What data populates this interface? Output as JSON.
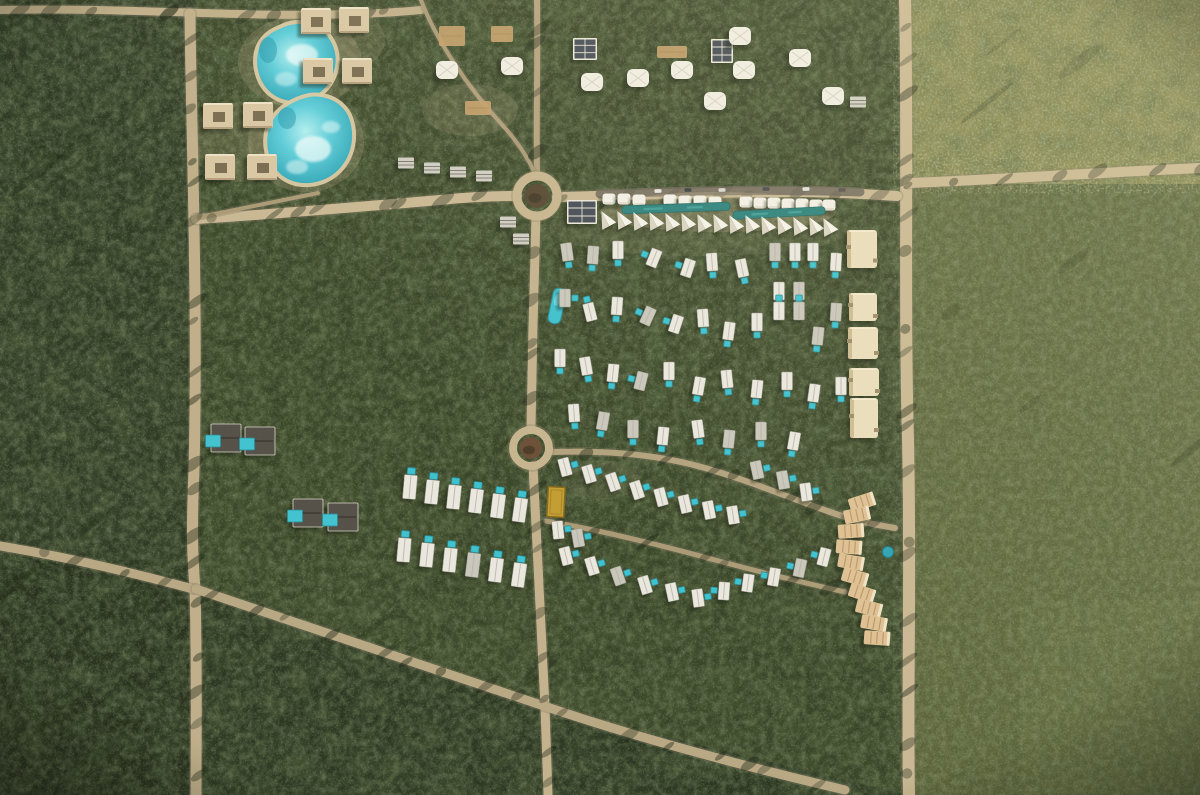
{
  "scene": {
    "size": {
      "w": 1200,
      "h": 795
    },
    "palette": {
      "jungle_dark": "#2f3a24",
      "jungle_mid": "#394528",
      "jungle_low": "#2c3822",
      "olive_block": "#84854f",
      "olive_right": "#5b6339",
      "road_tan": "#c9b893",
      "road_dim": "#bfae89",
      "asphalt": "#6e675c",
      "water_light": "#b2eef0",
      "water_mid": "#5ecdd9",
      "water_deep": "#31a5b6",
      "pool_teal": "#3fc2ce",
      "pool_strip": "#2e827d",
      "building_tan": "#d9c7a3",
      "building_white": "#eae7df",
      "building_cream": "#e9ddbb",
      "building_terracotta": "#ddc093",
      "solar_panel": "#474e56",
      "court_yellow": "#c29e33"
    },
    "regions": [
      {
        "name": "base-jungle",
        "shape": "rect",
        "x": 0,
        "y": 0,
        "w": 1200,
        "h": 795,
        "fill": "#36412a",
        "op": 1
      },
      {
        "name": "left-jungle-strip",
        "shape": "rect",
        "x": 0,
        "y": 0,
        "w": 196,
        "h": 795,
        "fill": "#2f3a24",
        "op": 1
      },
      {
        "name": "central-jungle",
        "shape": "rect",
        "x": 196,
        "y": 0,
        "w": 712,
        "h": 795,
        "fill": "#394528",
        "op": 1
      },
      {
        "name": "south-jungle-wedge",
        "shape": "poly",
        "points": "196,592 545,708 908,795 196,795",
        "fill": "#2c3822",
        "op": 1
      },
      {
        "name": "bottom-left-jungle",
        "shape": "rect",
        "x": 0,
        "y": 560,
        "w": 196,
        "h": 235,
        "fill": "#28321e",
        "op": 1
      },
      {
        "name": "top-right-olive-parcel",
        "shape": "rect",
        "x": 908,
        "y": 0,
        "w": 292,
        "h": 184,
        "fill": "#84854f",
        "op": 1
      },
      {
        "name": "right-olive-parcel",
        "shape": "rect",
        "x": 908,
        "y": 184,
        "w": 292,
        "h": 611,
        "fill": "#5b6339",
        "op": 1
      },
      {
        "name": "right-lower-light-patch",
        "shape": "rect",
        "x": 1020,
        "y": 600,
        "w": 180,
        "h": 195,
        "fill": "#646d40",
        "op": 0.5
      }
    ],
    "roads": [
      {
        "name": "top-edge-road",
        "d": "M0,10 C80,8 160,12 240,14 C320,16 380,14 421,10",
        "w": 8,
        "color": "#c0af8a"
      },
      {
        "name": "left-perimeter-road",
        "d": "M190,14 C191,120 198,300 194,470 C191,540 193,560 195,590 C197,660 196,730 196,795",
        "w": 11,
        "color": "#c0af8a"
      },
      {
        "name": "right-perimeter-road",
        "d": "M905,0 C908,140 904,300 908,440 C911,580 907,700 909,795",
        "w": 12,
        "color": "#c9b893"
      },
      {
        "name": "west-main-avenue",
        "d": "M196,219 C280,214 380,205 440,200 C470,197 495,196 517,196",
        "w": 10,
        "color": "#c9b893"
      },
      {
        "name": "north-service-track",
        "d": "M537,174 C536,120 538,60 537,0",
        "w": 6,
        "color": "#b3a27e"
      },
      {
        "name": "east-main-avenue",
        "d": "M557,197 C640,195 720,192 790,192 C830,192 865,194 897,196",
        "w": 10,
        "color": "#c9b893"
      },
      {
        "name": "northeast-boundary-road",
        "d": "M908,183 C990,180 1090,173 1200,168",
        "w": 10,
        "color": "#c9b893"
      },
      {
        "name": "central-spine-north",
        "d": "M536,216 C534,280 532,360 531,427",
        "w": 9,
        "color": "#c3b28d"
      },
      {
        "name": "central-spine-south",
        "d": "M533,466 C537,540 541,630 545,707 C546,740 547,770 548,795",
        "w": 9,
        "color": "#c3b28d"
      },
      {
        "name": "west-entry-road",
        "d": "M0,546 C60,556 130,572 193,589",
        "w": 9,
        "color": "#b9a884"
      },
      {
        "name": "southeast-diagonal-road",
        "d": "M196,589 C300,624 430,668 544,706 C650,742 760,770 845,790",
        "w": 9,
        "color": "#b9a884"
      },
      {
        "name": "villa-loop-north",
        "d": "M553,452 C610,450 660,455 705,468 C750,481 790,498 830,512 C855,521 875,525 895,528",
        "w": 6,
        "color": "#b3a27e"
      },
      {
        "name": "villa-loop-south",
        "d": "M546,521 C600,530 660,545 715,560 C760,572 800,582 845,592",
        "w": 5,
        "color": "#ab9a76"
      },
      {
        "name": "lagoon-footpath",
        "d": "M200,217 C240,209 280,201 318,193",
        "w": 4,
        "color": "#ab9a76"
      },
      {
        "name": "north-footpath",
        "d": "M421,0 C436,40 468,88 505,128 C518,143 528,158 534,172",
        "w": 4,
        "color": "#ab9a76"
      }
    ],
    "asphalt": {
      "name": "resort-front-lane",
      "d": "M600,194 C680,191 780,189 860,192",
      "w": 9,
      "color": "#6e675c"
    },
    "cars": [
      [
        658,
        191,
        -2,
        "#e8e7e1"
      ],
      [
        688,
        190,
        0,
        "#3c4140"
      ],
      [
        722,
        190,
        -2,
        "#d9d6cd"
      ],
      [
        766,
        189,
        0,
        "#474b51"
      ],
      [
        806,
        189,
        -2,
        "#e4e2da"
      ],
      [
        842,
        190,
        0,
        "#59544c"
      ]
    ],
    "roundabouts": [
      {
        "name": "north-roundabout",
        "cx": 537,
        "cy": 196,
        "r": 20,
        "ringW": 9,
        "ring": "#c7b590",
        "innerR": 12,
        "innerFill": "#584a33"
      },
      {
        "name": "south-roundabout",
        "cx": 531,
        "cy": 448,
        "r": 18,
        "ringW": 8,
        "ring": "#c7b590",
        "innerR": 11,
        "innerFill": "#6d5038"
      }
    ],
    "sand_patches": [
      [
        300,
        62,
        62,
        46,
        0.22
      ],
      [
        306,
        142,
        58,
        50,
        0.22
      ],
      [
        242,
        142,
        52,
        40,
        0.18
      ],
      [
        330,
        40,
        55,
        35,
        0.15
      ],
      [
        470,
        110,
        48,
        26,
        0.15
      ],
      [
        700,
        230,
        150,
        26,
        0.1
      ],
      [
        718,
        212,
        118,
        20,
        0.28
      ],
      [
        600,
        480,
        40,
        20,
        0.1
      ]
    ],
    "lagoons": [
      {
        "name": "north-lagoon",
        "d": "M282,28 C298,20 320,24 330,40 C340,56 336,76 324,89 C311,102 289,105 274,95 C259,85 253,63 260,46 C265,36 272,32 282,28 Z",
        "clouds": [
          [
            302,
            55,
            16,
            11,
            0.7
          ],
          [
            286,
            79,
            11,
            7,
            0.45
          ]
        ],
        "darks": [
          [
            268,
            50,
            9,
            13,
            0.45
          ]
        ]
      },
      {
        "name": "south-lagoon",
        "d": "M302,99 C320,92 342,100 349,118 C356,137 351,159 336,172 C321,185 298,187 283,176 C268,165 263,141 271,124 C277,111 290,103 302,99 Z",
        "clouds": [
          [
            313,
            149,
            18,
            13,
            0.75
          ],
          [
            331,
            127,
            9,
            6,
            0.5
          ],
          [
            297,
            167,
            11,
            7,
            0.5
          ]
        ],
        "darks": [
          [
            287,
            118,
            9,
            11,
            0.45
          ]
        ]
      }
    ],
    "buildings": {
      "courtyard": [
        [
          316,
          21
        ],
        [
          354,
          20
        ],
        [
          318,
          71
        ],
        [
          357,
          71
        ],
        [
          218,
          116
        ],
        [
          258,
          115
        ],
        [
          220,
          167
        ],
        [
          262,
          167
        ]
      ],
      "tents": [
        [
          447,
          70
        ],
        [
          512,
          66
        ],
        [
          592,
          82
        ],
        [
          638,
          78
        ],
        [
          682,
          70
        ],
        [
          740,
          36
        ],
        [
          715,
          101
        ],
        [
          744,
          70
        ],
        [
          800,
          58
        ],
        [
          833,
          96
        ]
      ],
      "solar": [
        [
          585,
          49,
          24,
          22
        ],
        [
          722,
          51,
          22,
          24
        ],
        [
          582,
          212,
          30,
          24
        ]
      ],
      "gray": [
        [
          406,
          163
        ],
        [
          432,
          168
        ],
        [
          458,
          172
        ],
        [
          484,
          176
        ],
        [
          858,
          102
        ],
        [
          508,
          222
        ],
        [
          521,
          239
        ]
      ],
      "decks": [
        [
          452,
          36,
          26,
          20
        ],
        [
          502,
          34,
          22,
          16
        ],
        [
          672,
          52,
          30,
          12
        ],
        [
          478,
          108,
          26,
          14
        ]
      ],
      "canopies": [
        [
          609,
          199
        ],
        [
          624,
          199
        ],
        [
          639,
          200
        ],
        [
          670,
          200
        ],
        [
          685,
          201
        ],
        [
          700,
          201
        ],
        [
          715,
          202
        ],
        [
          746,
          202
        ],
        [
          760,
          203
        ],
        [
          774,
          203
        ],
        [
          788,
          204
        ],
        [
          802,
          204
        ],
        [
          816,
          205
        ],
        [
          829,
          205
        ]
      ],
      "pool_strips": [
        [
          622,
          208,
          108,
          8,
          -2
        ],
        [
          733,
          213,
          92,
          8,
          -3
        ]
      ],
      "front_tents": [
        [
          606,
          220
        ],
        [
          622,
          220
        ],
        [
          638,
          221
        ],
        [
          654,
          221
        ],
        [
          670,
          222
        ],
        [
          686,
          222
        ],
        [
          702,
          223
        ],
        [
          718,
          223
        ],
        [
          734,
          224
        ],
        [
          750,
          224
        ],
        [
          766,
          225
        ],
        [
          782,
          225
        ],
        [
          798,
          226
        ],
        [
          814,
          226
        ],
        [
          828,
          227
        ]
      ],
      "cream": [
        [
          862,
          249,
          30,
          38
        ],
        [
          863,
          307,
          28,
          28
        ],
        [
          863,
          343,
          30,
          32
        ],
        [
          864,
          382,
          30,
          28
        ],
        [
          864,
          418,
          28,
          40
        ]
      ],
      "slabs": [
        [
          862,
          502,
          -18
        ],
        [
          857,
          515,
          -12
        ],
        [
          851,
          531,
          -4
        ],
        [
          849,
          547,
          4
        ],
        [
          851,
          562,
          10
        ],
        [
          855,
          577,
          16
        ],
        [
          862,
          593,
          18
        ],
        [
          869,
          608,
          14
        ],
        [
          874,
          623,
          10
        ],
        [
          877,
          638,
          4
        ]
      ],
      "slab_pool": [
        888,
        552,
        5.5
      ],
      "dark_villas": [
        [
          226,
          438
        ],
        [
          260,
          441
        ],
        [
          308,
          513
        ],
        [
          343,
          517
        ]
      ],
      "court": {
        "x": 556,
        "y": 502,
        "w": 17,
        "h": 30,
        "rot": 3
      },
      "long_pool": {
        "x": 557,
        "y": 306,
        "w": 13,
        "h": 36,
        "rot": 12
      }
    },
    "villas": {
      "upper": [
        [
          567,
          252,
          -8,
          "s"
        ],
        [
          593,
          255,
          4,
          "s"
        ],
        [
          618,
          250,
          0,
          "s"
        ],
        [
          654,
          258,
          22,
          "w"
        ],
        [
          688,
          268,
          18,
          "w"
        ],
        [
          712,
          262,
          -4,
          "s"
        ],
        [
          742,
          268,
          -12,
          "s"
        ],
        [
          775,
          252,
          0,
          "s"
        ],
        [
          795,
          252,
          0,
          "s"
        ],
        [
          813,
          252,
          0,
          "s"
        ],
        [
          836,
          262,
          3,
          "s"
        ],
        [
          565,
          298,
          0,
          "e"
        ],
        [
          590,
          312,
          -14,
          "n"
        ],
        [
          617,
          306,
          4,
          "s"
        ],
        [
          648,
          316,
          24,
          "w"
        ],
        [
          676,
          324,
          18,
          "w"
        ],
        [
          703,
          318,
          -4,
          "s"
        ],
        [
          729,
          331,
          8,
          "s"
        ],
        [
          757,
          322,
          0,
          "s"
        ],
        [
          779,
          291,
          0,
          "s"
        ],
        [
          799,
          291,
          0,
          "s"
        ],
        [
          779,
          311,
          0,
          "n"
        ],
        [
          799,
          311,
          0,
          "n"
        ],
        [
          836,
          312,
          4,
          "s"
        ],
        [
          818,
          336,
          6,
          "s"
        ],
        [
          560,
          358,
          0,
          "s"
        ],
        [
          586,
          366,
          -10,
          "s"
        ],
        [
          613,
          373,
          6,
          "s"
        ],
        [
          641,
          381,
          14,
          "w"
        ],
        [
          669,
          371,
          0,
          "s"
        ],
        [
          699,
          386,
          10,
          "s"
        ],
        [
          727,
          379,
          -6,
          "s"
        ],
        [
          757,
          389,
          6,
          "s"
        ],
        [
          787,
          381,
          0,
          "s"
        ],
        [
          814,
          393,
          8,
          "s"
        ],
        [
          841,
          386,
          0,
          "s"
        ],
        [
          574,
          413,
          -4,
          "s"
        ],
        [
          603,
          421,
          10,
          "s"
        ],
        [
          633,
          429,
          0,
          "s"
        ],
        [
          663,
          436,
          6,
          "s"
        ],
        [
          698,
          429,
          -8,
          "s"
        ],
        [
          729,
          439,
          6,
          "s"
        ],
        [
          761,
          431,
          0,
          "s"
        ],
        [
          794,
          441,
          10,
          "s"
        ]
      ],
      "lower_east": [
        [
          565,
          467,
          -15,
          "e"
        ],
        [
          589,
          474,
          -17,
          "e"
        ],
        [
          613,
          482,
          -19,
          "e"
        ],
        [
          637,
          490,
          -18,
          "e"
        ],
        [
          661,
          497,
          -15,
          "e"
        ],
        [
          685,
          504,
          -13,
          "e"
        ],
        [
          709,
          510,
          -11,
          "e"
        ],
        [
          733,
          515,
          -9,
          "e"
        ],
        [
          757,
          470,
          -12,
          "e"
        ],
        [
          783,
          480,
          -10,
          "e"
        ],
        [
          806,
          492,
          -8,
          "e"
        ],
        [
          558,
          530,
          -6,
          "e"
        ],
        [
          578,
          538,
          -10,
          "e"
        ],
        [
          566,
          556,
          -14,
          "e"
        ],
        [
          592,
          566,
          -17,
          "e"
        ],
        [
          618,
          576,
          -19,
          "e"
        ],
        [
          645,
          585,
          -17,
          "e"
        ],
        [
          672,
          592,
          -12,
          "e"
        ],
        [
          698,
          598,
          -8,
          "e"
        ],
        [
          724,
          591,
          4,
          "w"
        ],
        [
          748,
          583,
          8,
          "w"
        ],
        [
          774,
          577,
          10,
          "w"
        ],
        [
          800,
          568,
          12,
          "w"
        ],
        [
          824,
          557,
          14,
          "w"
        ]
      ],
      "lower_west": [
        [
          410,
          487,
          5
        ],
        [
          432,
          492,
          6
        ],
        [
          454,
          497,
          6
        ],
        [
          476,
          501,
          7
        ],
        [
          498,
          506,
          7
        ],
        [
          520,
          510,
          8
        ],
        [
          404,
          550,
          5
        ],
        [
          427,
          555,
          6
        ],
        [
          450,
          560,
          6
        ],
        [
          473,
          565,
          7
        ],
        [
          496,
          570,
          7
        ],
        [
          519,
          575,
          8
        ]
      ]
    }
  }
}
